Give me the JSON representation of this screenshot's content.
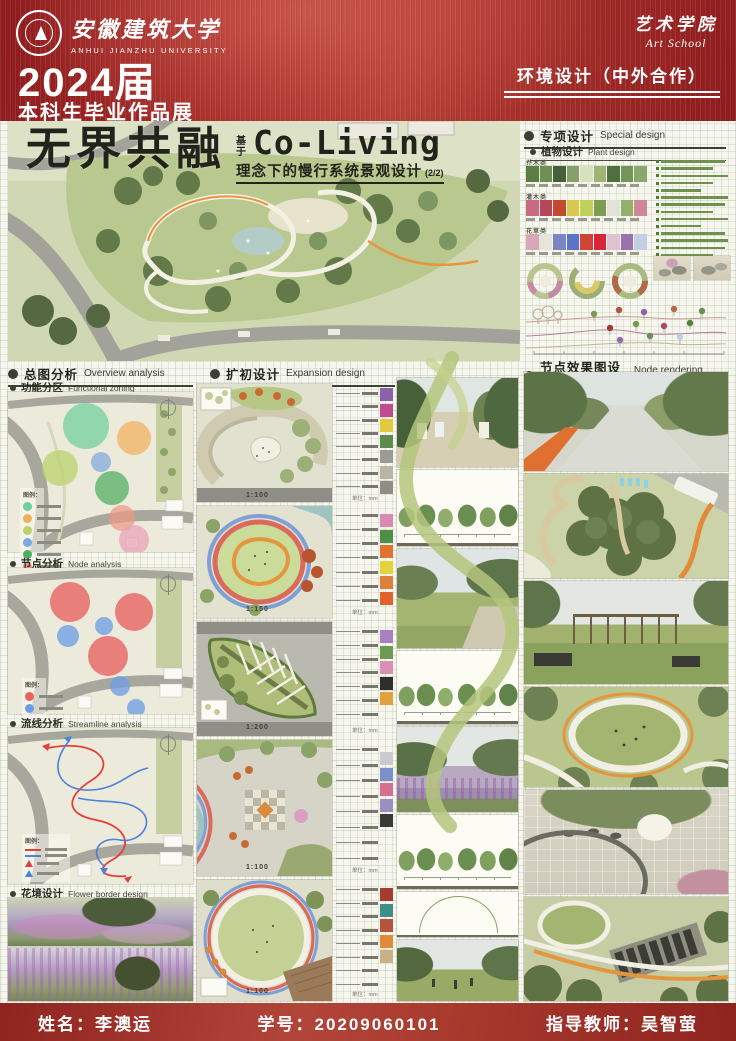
{
  "header": {
    "university_cn": "安徽建筑大学",
    "university_en": "ANHUI JIANZHU UNIVERSITY",
    "school_cn": "艺术学院",
    "school_en": "Art School",
    "year": "2024届",
    "exhibition": "本科生毕业作品展",
    "program": "环境设计（中外合作）"
  },
  "title": {
    "main": "无界共融",
    "prefix": "基于",
    "en": "Co-Living",
    "subtitle": "理念下的慢行系统景观设计",
    "sheet": "(2/2)"
  },
  "sections": {
    "special": {
      "cn": "专项设计",
      "en": "Special design"
    },
    "plant": {
      "cn": "植物设计",
      "en": "Plant design"
    },
    "overview": {
      "cn": "总图分析",
      "en": "Overview analysis"
    },
    "zoning": {
      "cn": "功能分区",
      "en": "Functional zoning"
    },
    "node": {
      "cn": "节点分析",
      "en": "Node analysis"
    },
    "streamline": {
      "cn": "流线分析",
      "en": "Streamline analysis"
    },
    "flower": {
      "cn": "花境设计",
      "en": "Flower border design"
    },
    "expansion": {
      "cn": "扩初设计",
      "en": "Expansion design"
    },
    "rendering": {
      "cn": "节点效果图设计",
      "en": "Node rendering design"
    }
  },
  "plant_rows": [
    {
      "label": "乔木类",
      "colors": [
        "#5a7d44",
        "#6f8f53",
        "#46603a",
        "#86a06a",
        "#d8e0c2",
        "#9fb377",
        "#4e7040",
        "#77935c",
        "#8aa86b"
      ]
    },
    {
      "label": "灌木类",
      "colors": [
        "#c96a85",
        "#b4485a",
        "#c24a33",
        "#d9c84e",
        "#c3cf5c",
        "#7f9c55",
        "#e0e3d6",
        "#92b06a",
        "#cf8799"
      ]
    },
    {
      "label": "花草类",
      "colors": [
        "#d9a8b8",
        "#e8e4da",
        "#7a86c2",
        "#5b74c8",
        "#cf4436",
        "#d5263a",
        "#e0c1cf",
        "#9a72b0",
        "#c2cfe0"
      ]
    }
  ],
  "legend_title": "图例：",
  "zoning_legend_colors": [
    "#6fcf9b",
    "#f0b05c",
    "#b8d36a",
    "#7fa8e0",
    "#4daf5e",
    "#ef9a83"
  ],
  "node_legend_colors": [
    "#e86060",
    "#6f9de3"
  ],
  "plans": [
    {
      "scale": "1:100"
    },
    {
      "scale": "1:150"
    },
    {
      "scale": "1:200"
    },
    {
      "scale": "1:100"
    },
    {
      "scale": "1:100"
    }
  ],
  "unit_note": "单位：mm",
  "strips": {
    "s1": [
      "#8a62a8",
      "#c04b8f",
      "#e3c93e",
      "#5f8a4e",
      "#9b9b93",
      "#b9b4a6",
      "#8f8d85"
    ],
    "s2": [
      "#d88bb1",
      "#4f8f45",
      "#e0712f",
      "#e6d23a",
      "#e07f3b",
      "#e2622e"
    ],
    "s3": [
      "#a77fc2",
      "#6b9a50",
      "#d990b5",
      "#2e2e2a",
      "#e1a13c"
    ],
    "s4": [
      "#c9cbd0",
      "#7b8fc9",
      "#d76f8e",
      "#9b8fc0",
      "#3a3a38"
    ],
    "s5": [
      "#a43b2e",
      "#3e8f8a",
      "#b4543a",
      "#e08a3a",
      "#c8b089"
    ]
  },
  "footer": {
    "name_label": "姓名：",
    "name": "李澳运",
    "id_label": "学号：",
    "id": "20209060101",
    "advisor_label": "指导教师：",
    "advisor": "吴智萤"
  },
  "colors": {
    "banner_red": "#a9302b",
    "footer_red": "#a93a2e",
    "ribbon_green": "#b4c67c",
    "track_red": "#d96a5c",
    "track_blue": "#7f9fd6",
    "path_orange": "#e6953f"
  }
}
